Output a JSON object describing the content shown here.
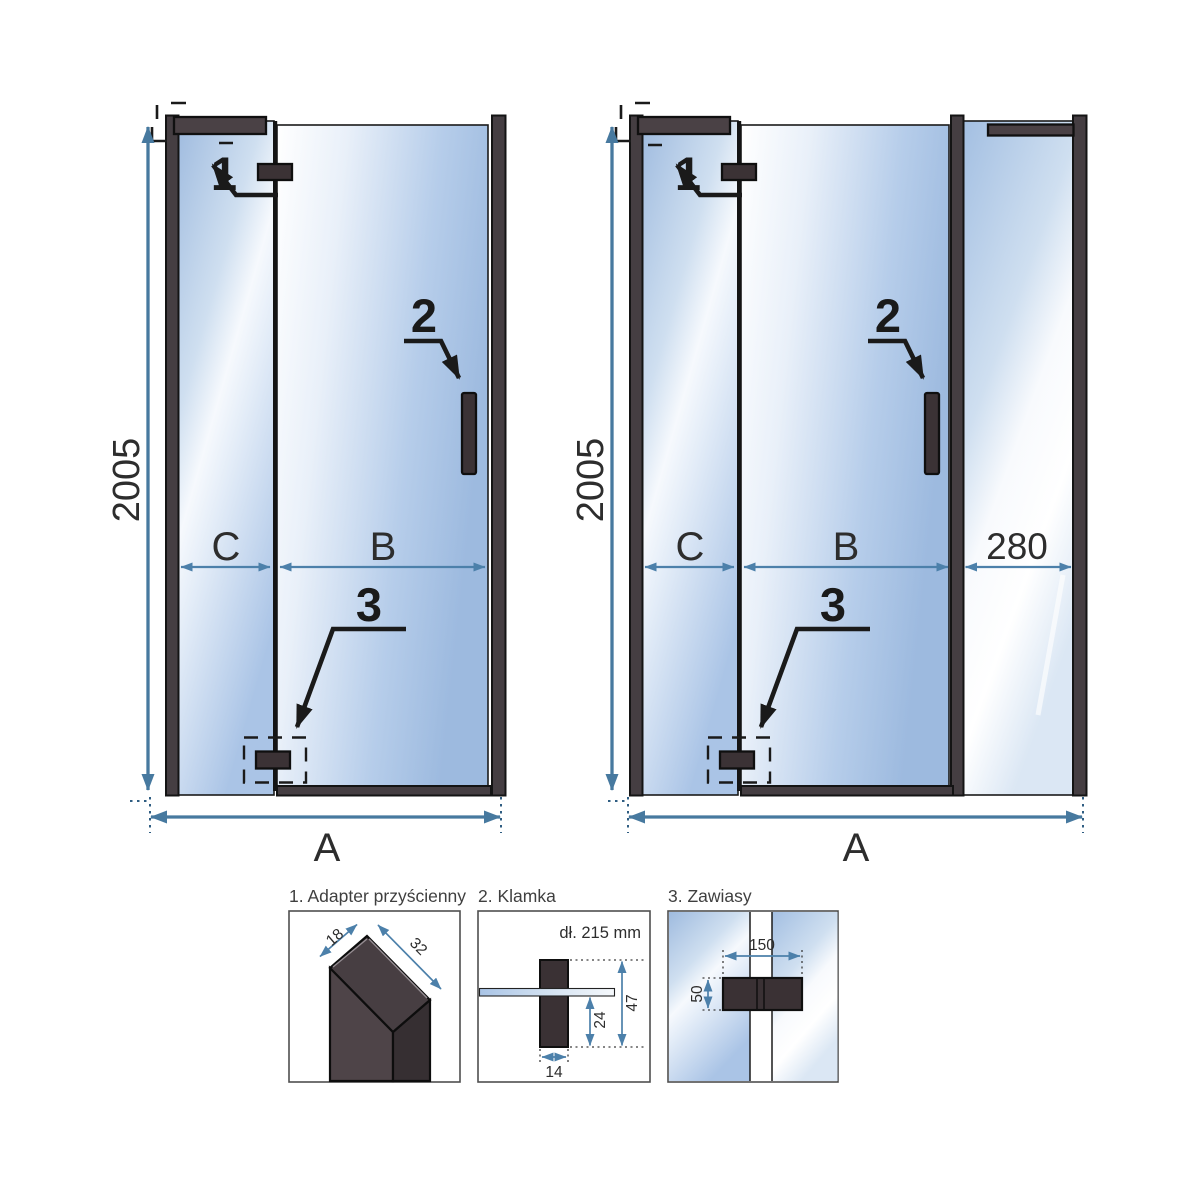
{
  "colors": {
    "dimension_blue": "#4c80aa",
    "frame_dark": "#453e42",
    "hardware_dark": "#3b3235",
    "glass_blue": "#a7c0e3",
    "text": "#2d2d2d"
  },
  "diagram_left": {
    "height": "2005",
    "segment_fixed": "C",
    "segment_door": "B",
    "total_width": "A",
    "callout_adapter": "1",
    "callout_handle": "2",
    "callout_hinges": "3"
  },
  "diagram_right": {
    "height": "2005",
    "segment_fixed": "C",
    "segment_door": "B",
    "segment_side_panel": "280",
    "total_width": "A",
    "callout_adapter": "1",
    "callout_handle": "2",
    "callout_hinges": "3"
  },
  "details": {
    "adapter": {
      "title": "1. Adapter przyścienny",
      "dim_depth": "18",
      "dim_width": "32"
    },
    "handle": {
      "title": "2. Klamka",
      "length_label": "dł. 215 mm",
      "dim_width": "14",
      "dim_below_glass": "24",
      "dim_total_height": "47"
    },
    "hinges": {
      "title": "3. Zawiasy",
      "dim_width": "150",
      "dim_height": "50"
    }
  }
}
